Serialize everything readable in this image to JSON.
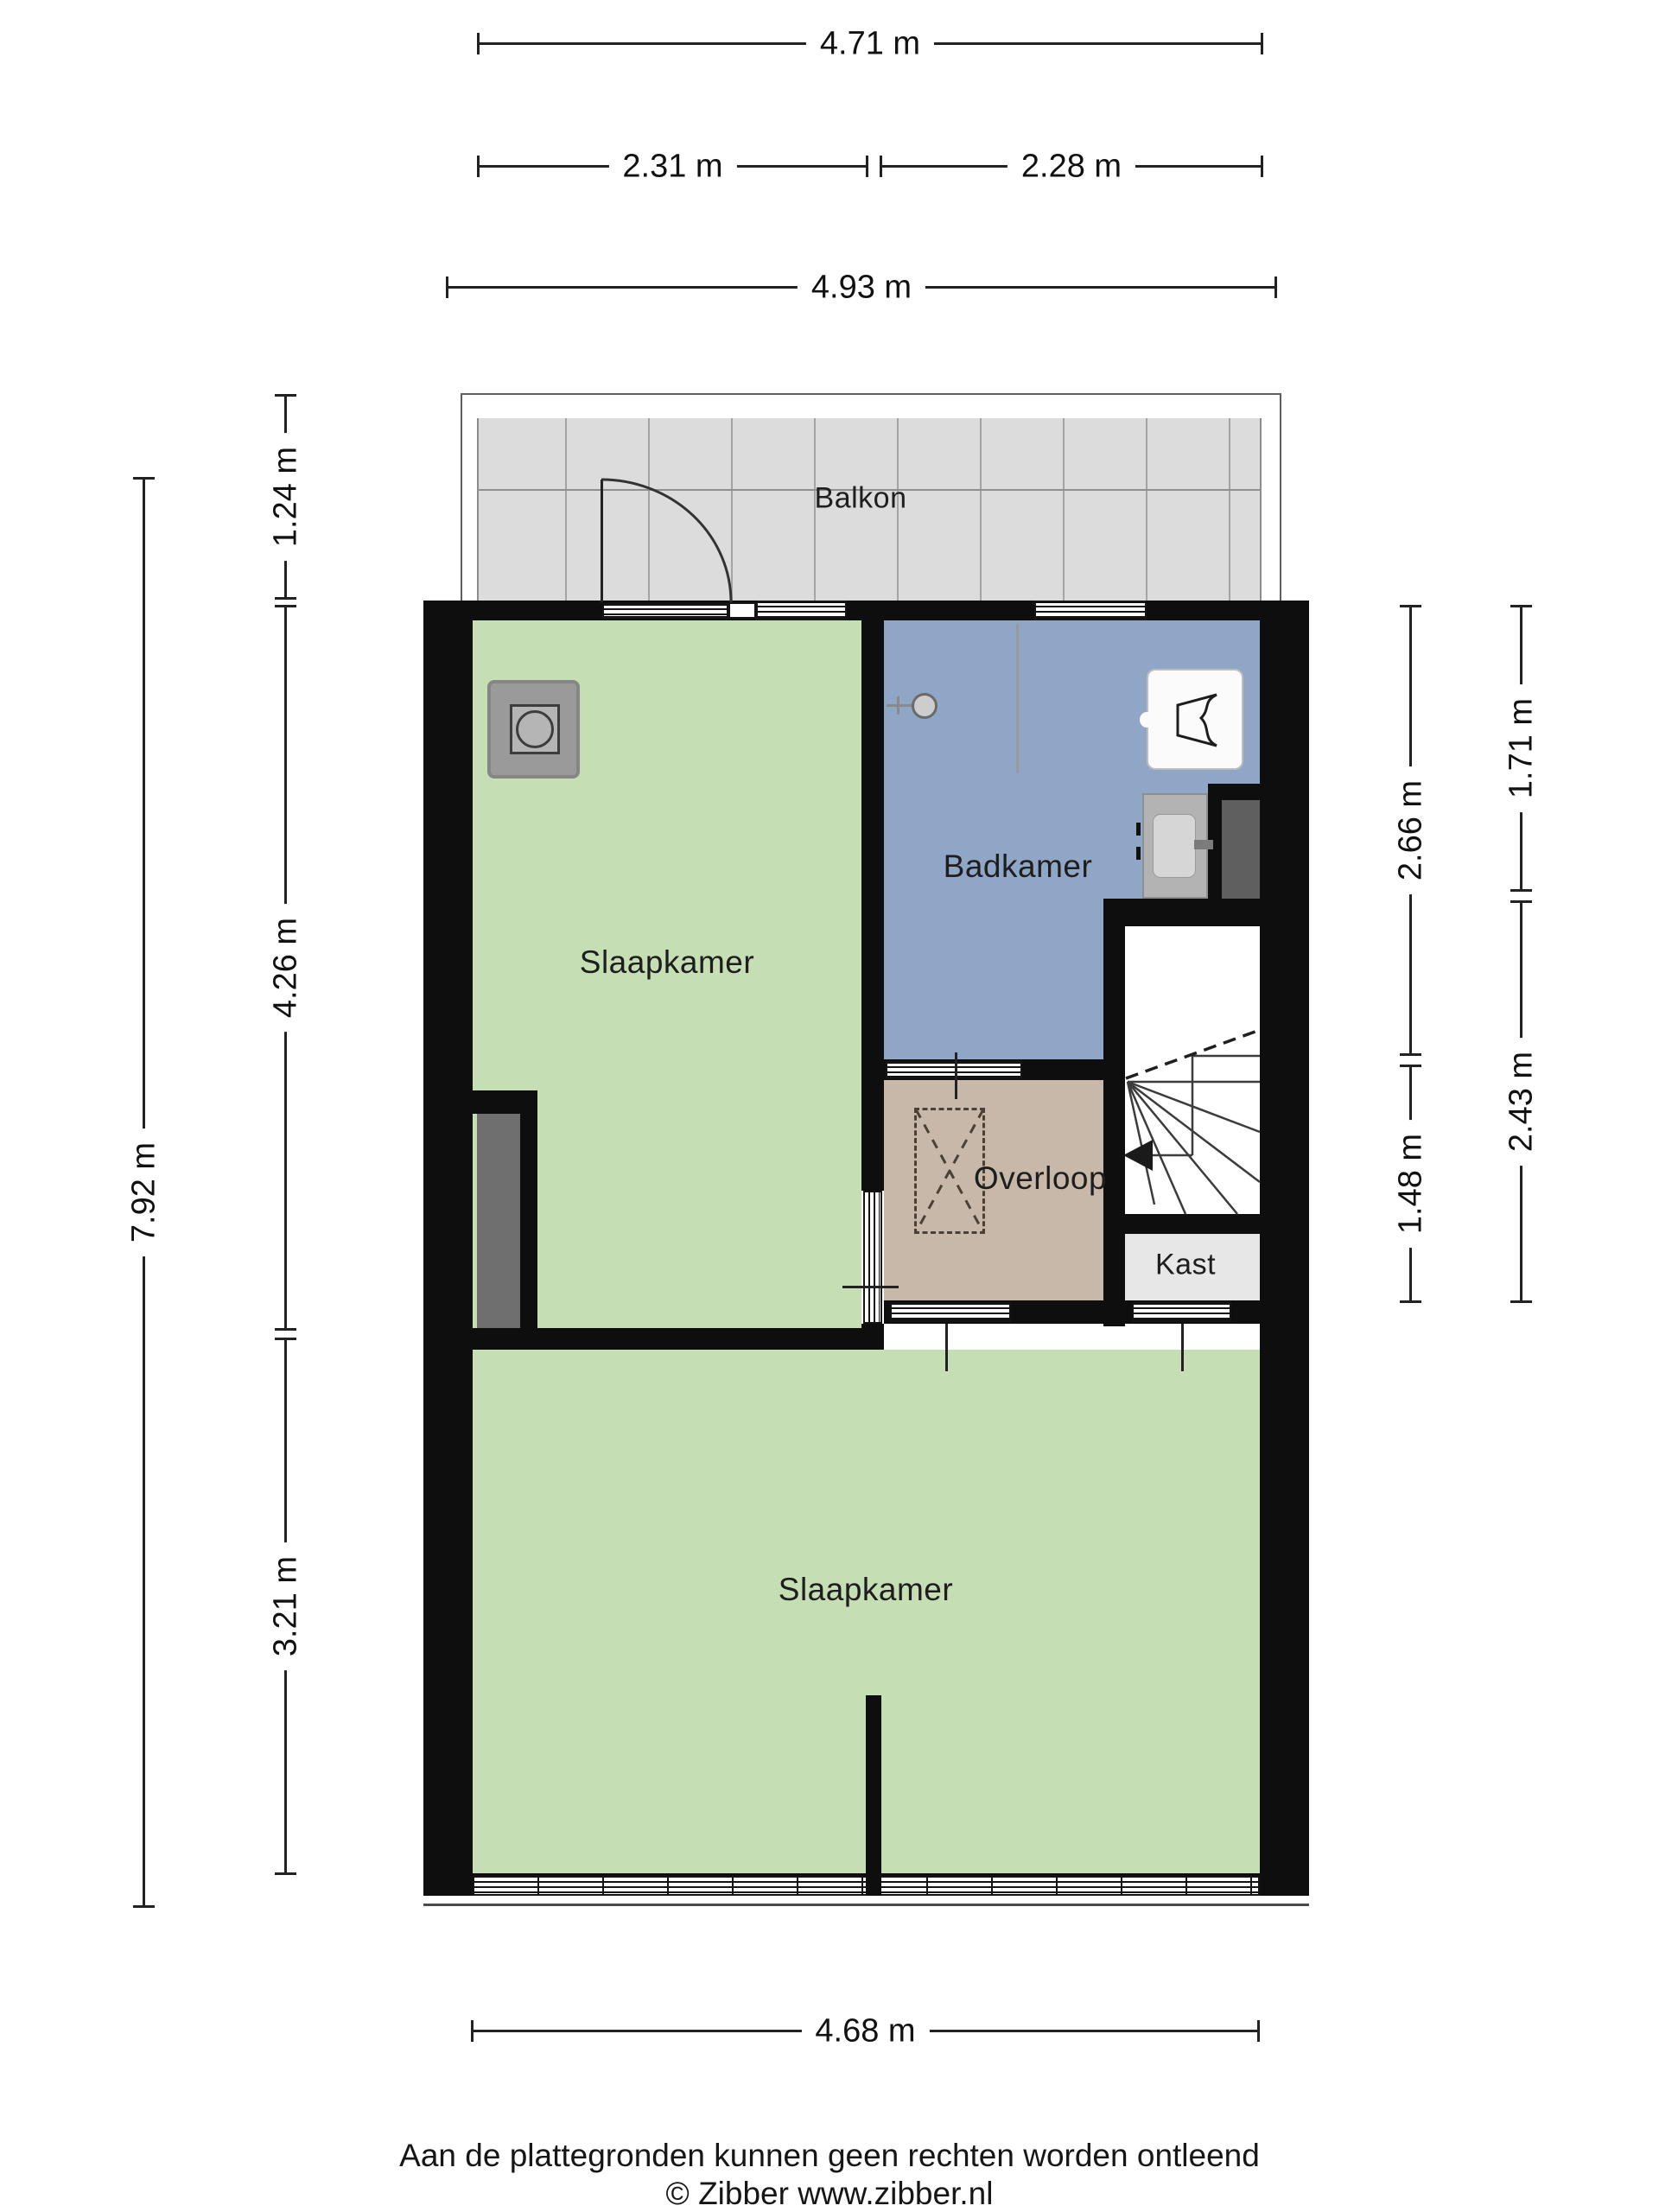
{
  "rooms": {
    "balkon": "Balkon",
    "slaapkamer1": "Slaapkamer",
    "badkamer": "Badkamer",
    "overloop": "Overloop",
    "kast": "Kast",
    "slaapkamer2": "Slaapkamer"
  },
  "dimensions": {
    "top_total": "4.71 m",
    "top_left": "2.31 m",
    "top_right": "2.28 m",
    "top_outer": "4.93 m",
    "left_total": "7.92 m",
    "left_balcony": "1.24 m",
    "left_mid": "4.26 m",
    "left_bottom": "3.21 m",
    "right_inner_top": "2.66 m",
    "right_inner_bottom": "1.48 m",
    "right_outer_top": "1.71 m",
    "right_outer_bottom": "2.43 m",
    "bottom_total": "4.68 m"
  },
  "footer": {
    "line1": "Aan de plattegronden kunnen geen rechten worden ontleend",
    "line2": "© Zibber www.zibber.nl"
  },
  "colors": {
    "wall": "#0e0e0e",
    "bedroom_green": "#c6deb4",
    "bathroom_blue": "#8fa6c7",
    "landing_tan": "#c8b8a9",
    "balcony_gray": "#dcdcdc",
    "closet_gray": "#e7e7e7",
    "shaft_gray": "#5f5f5f",
    "wardrobe_gray": "#6f6f6f"
  },
  "icons": {
    "washer": "washing-machine",
    "shower": "shower-head",
    "toilet": "toilet",
    "sink": "sink",
    "stairs": "stairs-down-arrow",
    "hatch": "attic-hatch"
  }
}
